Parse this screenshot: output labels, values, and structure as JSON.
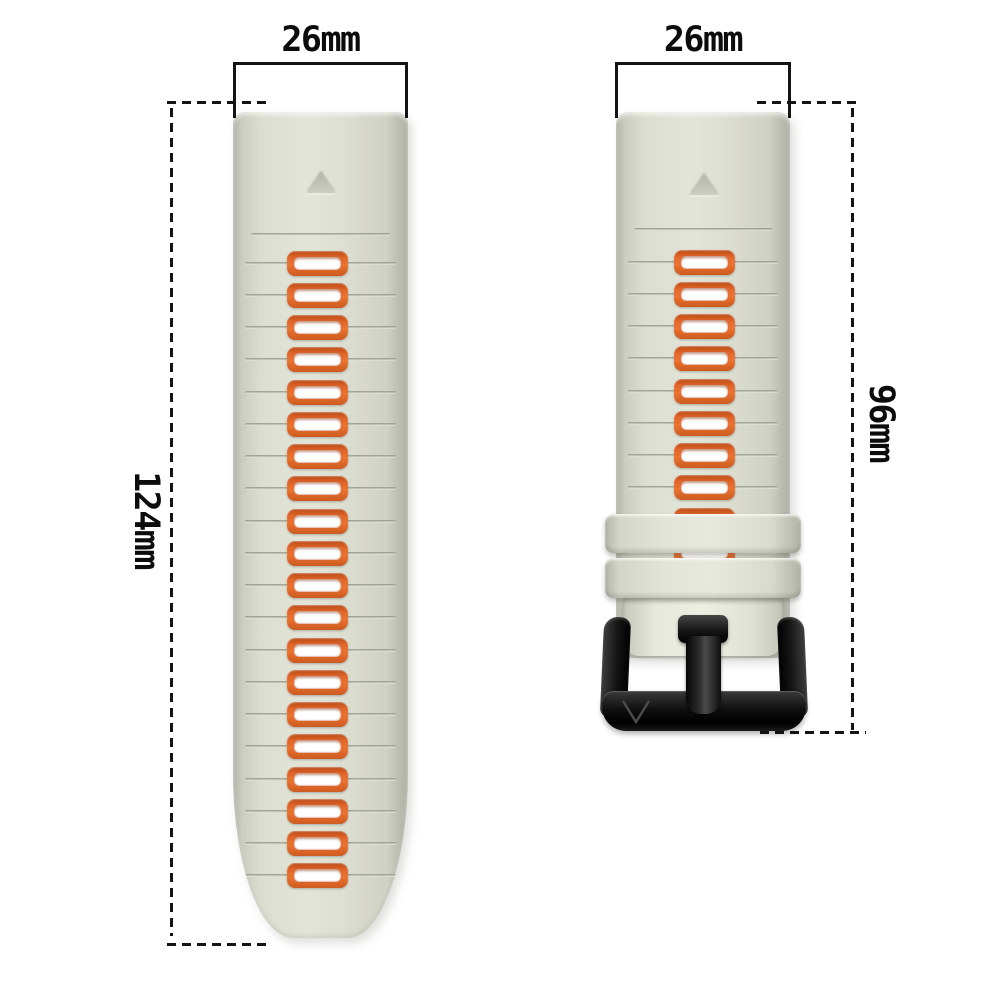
{
  "title": "watch band size diagram",
  "dimensions": {
    "left_band_width": "26mm",
    "right_band_width": "26mm",
    "left_band_length": "124mm",
    "right_band_length": "96mm"
  },
  "left_band": {
    "slot_count": 20,
    "marker": "triangle-up"
  },
  "right_band": {
    "slot_count": 10,
    "keeper_count": 2,
    "marker": "triangle-up",
    "buckle": {
      "logo_text": "V"
    }
  },
  "colors": {
    "background": "#ffffff",
    "band": "#dcded1",
    "band_edge": "#b0b2a5",
    "slot_orange": "#e2662a",
    "slot_hole": "#ffffff",
    "buckle_black": "#1a1a1a",
    "annotation": "#141414"
  }
}
